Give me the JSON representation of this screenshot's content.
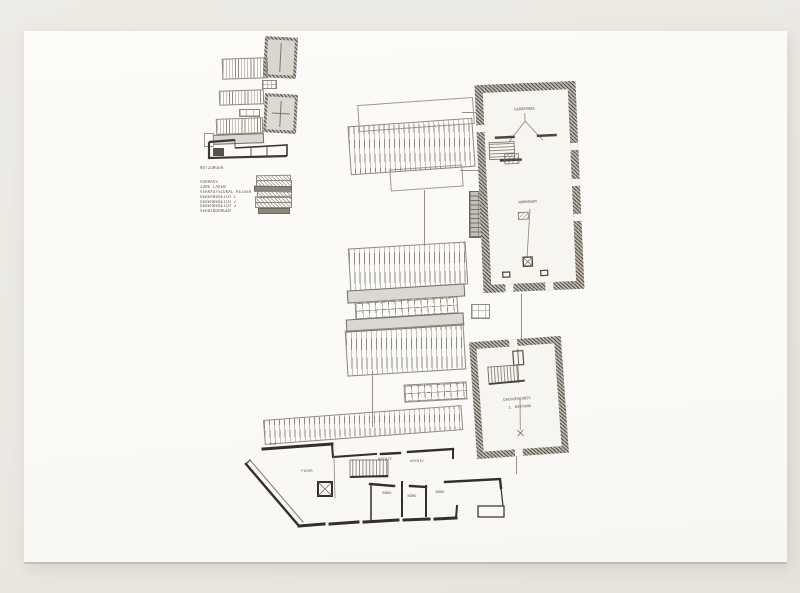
{
  "legend": {
    "title": "NUTZUNGEN",
    "items": [
      {
        "label": "VORHAUS"
      },
      {
        "label": "ZONE LADEN"
      },
      {
        "label": "VERKAUFSLOKAL REISER"
      },
      {
        "label": "UEBERBEREICH 1"
      },
      {
        "label": "UEBERBEREICH 2"
      },
      {
        "label": "UEBERBEREICH 3"
      },
      {
        "label": "VERBINDUNGEN"
      }
    ]
  },
  "buildings": {
    "main_hall": {
      "room_top": "GARDEROBE",
      "room_main": "WOHNRAUM"
    },
    "annex": {
      "line1": "DACHGESCHOSS",
      "line2": "1. BESTAND"
    },
    "office_wing": {
      "hall": "FOYER",
      "note": "A.6",
      "archiv_1": "ARCHIV",
      "archiv_2": "ARCHIV",
      "buero_1": "BÜRO",
      "buero_2": "BÜRO",
      "buero_3": "BÜRO"
    }
  },
  "colors": {
    "background": "#eae7e1",
    "paper": "#fbfaf6",
    "ink": "#4b4840",
    "wall_dark": "#37342e",
    "line_light": "#8e8a80"
  }
}
